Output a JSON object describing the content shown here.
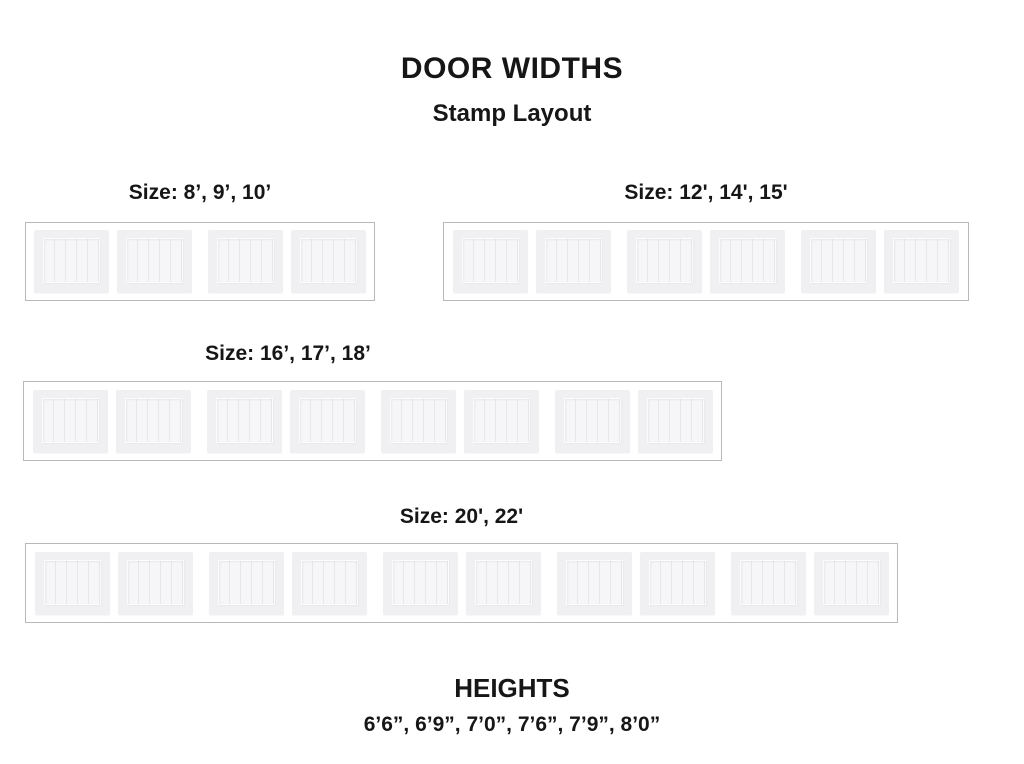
{
  "page": {
    "title": "DOOR WIDTHS",
    "subtitle": "Stamp Layout"
  },
  "groups": [
    {
      "label": "Size: 8’, 9’, 10’",
      "panels": 4,
      "stamps": 2,
      "panels_per_stamp": 2
    },
    {
      "label": "Size: 12', 14', 15'",
      "panels": 6,
      "stamps": 3,
      "panels_per_stamp": 2
    },
    {
      "label": "Size: 16’, 17’, 18’",
      "panels": 8,
      "stamps": 4,
      "panels_per_stamp": 2
    },
    {
      "label": "Size: 20', 22'",
      "panels": 10,
      "stamps": 5,
      "panels_per_stamp": 2
    }
  ],
  "heights": {
    "title": "HEIGHTS",
    "values": "6’6”, 6’9”, 7’0”, 7’6”, 7’9”, 8’0”"
  },
  "colors": {
    "text": "#161616",
    "box_border": "#b8b8bb",
    "panel": "#f0f0f2",
    "panel_inner": "#f6f6f8"
  }
}
